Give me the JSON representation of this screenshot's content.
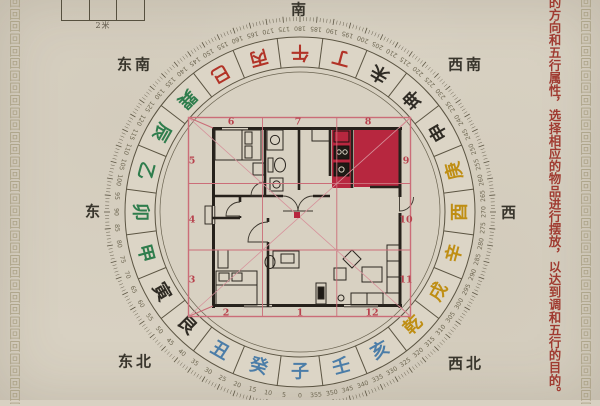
{
  "page": {
    "background": "#d8d1c2"
  },
  "border_pattern": {
    "char": "回",
    "repeat": 34
  },
  "scale_bar": {
    "label": "2米",
    "cells": 3
  },
  "annotation": {
    "vertical_text": "的方向和五行属性，选择相应的物品进行摆放，以达到调和五行的目的。",
    "color": "#a03b31"
  },
  "compass": {
    "direction_labels": [
      {
        "id": "south",
        "text": "南"
      },
      {
        "id": "southeast",
        "text": "东南"
      },
      {
        "id": "southwest",
        "text": "西南"
      },
      {
        "id": "east",
        "text": "东"
      },
      {
        "id": "west",
        "text": "西"
      },
      {
        "id": "northeast",
        "text": "东北"
      },
      {
        "id": "northwest",
        "text": "西北"
      }
    ],
    "element_colors": {
      "water": "#4b7da8",
      "wood": "#2f7d4d",
      "fire": "#b23327",
      "metal": "#bf8e13",
      "earth": "#2f2b24"
    },
    "mountains": [
      {
        "char": "子",
        "element": "water"
      },
      {
        "char": "癸",
        "element": "water"
      },
      {
        "char": "丑",
        "element": "water"
      },
      {
        "char": "艮",
        "element": "earth"
      },
      {
        "char": "寅",
        "element": "earth"
      },
      {
        "char": "甲",
        "element": "wood"
      },
      {
        "char": "卯",
        "element": "wood"
      },
      {
        "char": "乙",
        "element": "wood"
      },
      {
        "char": "辰",
        "element": "wood"
      },
      {
        "char": "巽",
        "element": "wood"
      },
      {
        "char": "巳",
        "element": "fire"
      },
      {
        "char": "丙",
        "element": "fire"
      },
      {
        "char": "午",
        "element": "fire"
      },
      {
        "char": "丁",
        "element": "fire"
      },
      {
        "char": "未",
        "element": "earth"
      },
      {
        "char": "坤",
        "element": "earth"
      },
      {
        "char": "申",
        "element": "earth"
      },
      {
        "char": "庚",
        "element": "metal"
      },
      {
        "char": "酉",
        "element": "metal"
      },
      {
        "char": "辛",
        "element": "metal"
      },
      {
        "char": "戌",
        "element": "metal"
      },
      {
        "char": "乾",
        "element": "metal"
      },
      {
        "char": "亥",
        "element": "water"
      },
      {
        "char": "壬",
        "element": "water"
      }
    ],
    "degree_scale": {
      "start": 0,
      "step": 5,
      "count": 72,
      "south_at_top": 180
    }
  },
  "floor_plan": {
    "palace_numbers": [
      "1",
      "2",
      "3",
      "4",
      "5",
      "6",
      "7",
      "8",
      "9",
      "10",
      "11",
      "12"
    ],
    "highlight_color": "#b7273f",
    "grid_color": "#cb6d78",
    "number_color": "#b8434e"
  }
}
